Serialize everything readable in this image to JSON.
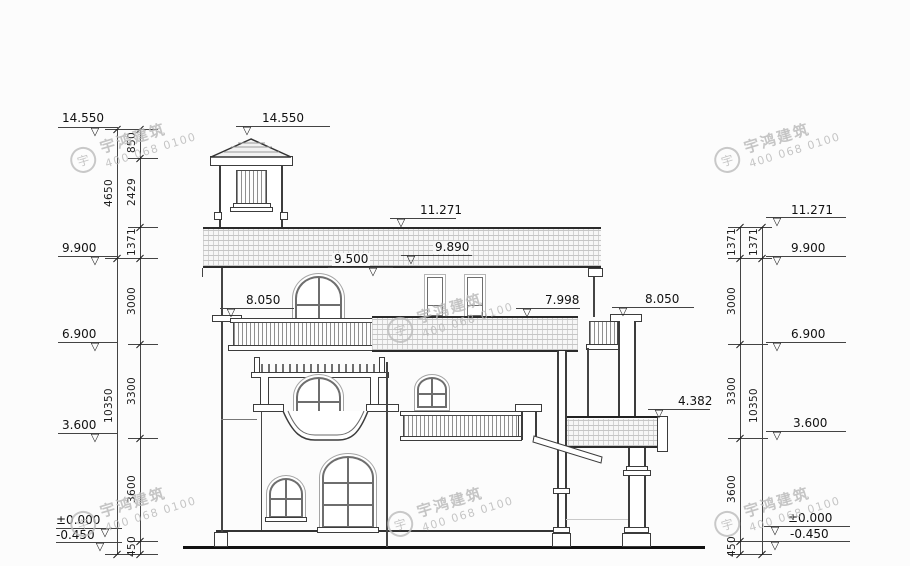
{
  "brand": {
    "name": "宇鸿建筑",
    "phone": "400 068 0100",
    "logo": "宇"
  },
  "glyphs": {
    "elevation_triangle": "▽"
  },
  "elev_left": [
    "14.550",
    "9.900",
    "6.900",
    "3.600",
    "±0.000",
    "-0.450"
  ],
  "elev_right": [
    "11.271",
    "9.900",
    "6.900",
    "3.600",
    "±0.000",
    "-0.450"
  ],
  "elev_building": {
    "tower": "14.550",
    "ridge": "11.271",
    "roof_mid": "9.890",
    "roof_low": "9.500",
    "ledge_left": "8.050",
    "pent_roof": "7.998",
    "pillar_right": "8.050",
    "balcony": "4.382"
  },
  "dims_left_outer": [
    "4650",
    "10350"
  ],
  "dims_left_inner": [
    "850",
    "2429",
    "1371",
    "3000",
    "3300",
    "3600",
    "450"
  ],
  "dims_right_outer": [
    "1371",
    "3000",
    "3300",
    "3600",
    "450"
  ],
  "dims_right_inner": [
    "1371",
    "10350"
  ]
}
